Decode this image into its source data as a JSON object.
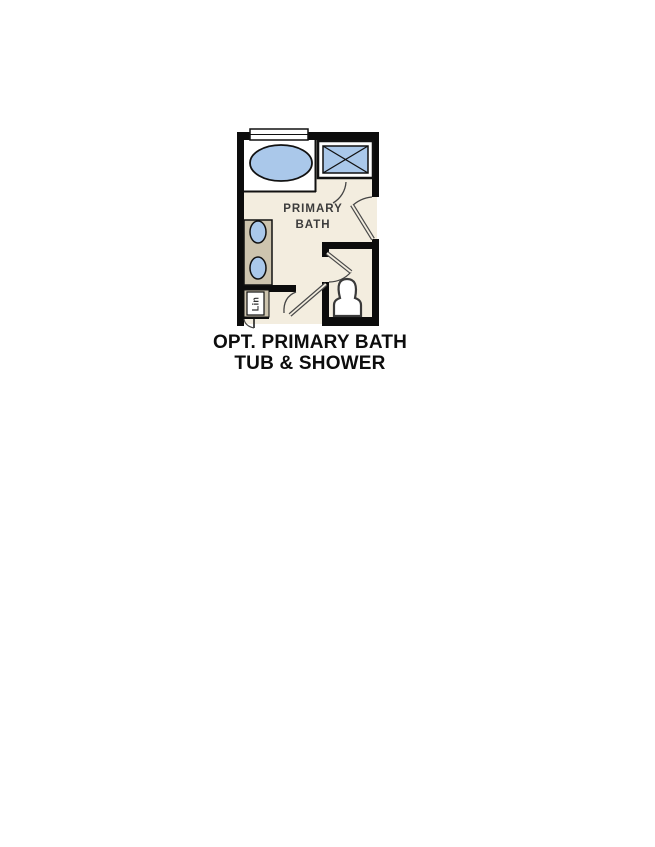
{
  "floor_plan": {
    "room_label_line1": "PRIMARY",
    "room_label_line2": "BATH",
    "linen_label": "Lin",
    "colors": {
      "wall": "#0c0c0c",
      "floor": "#f3eddf",
      "fixture_blue": "#aac8ea",
      "vanity_tan": "#cdc4ae",
      "white": "#ffffff",
      "outline": "#1a1a1a",
      "label": "#3c3c3c"
    }
  },
  "caption": {
    "line1": "OPT. PRIMARY BATH",
    "line2": "TUB & SHOWER"
  }
}
